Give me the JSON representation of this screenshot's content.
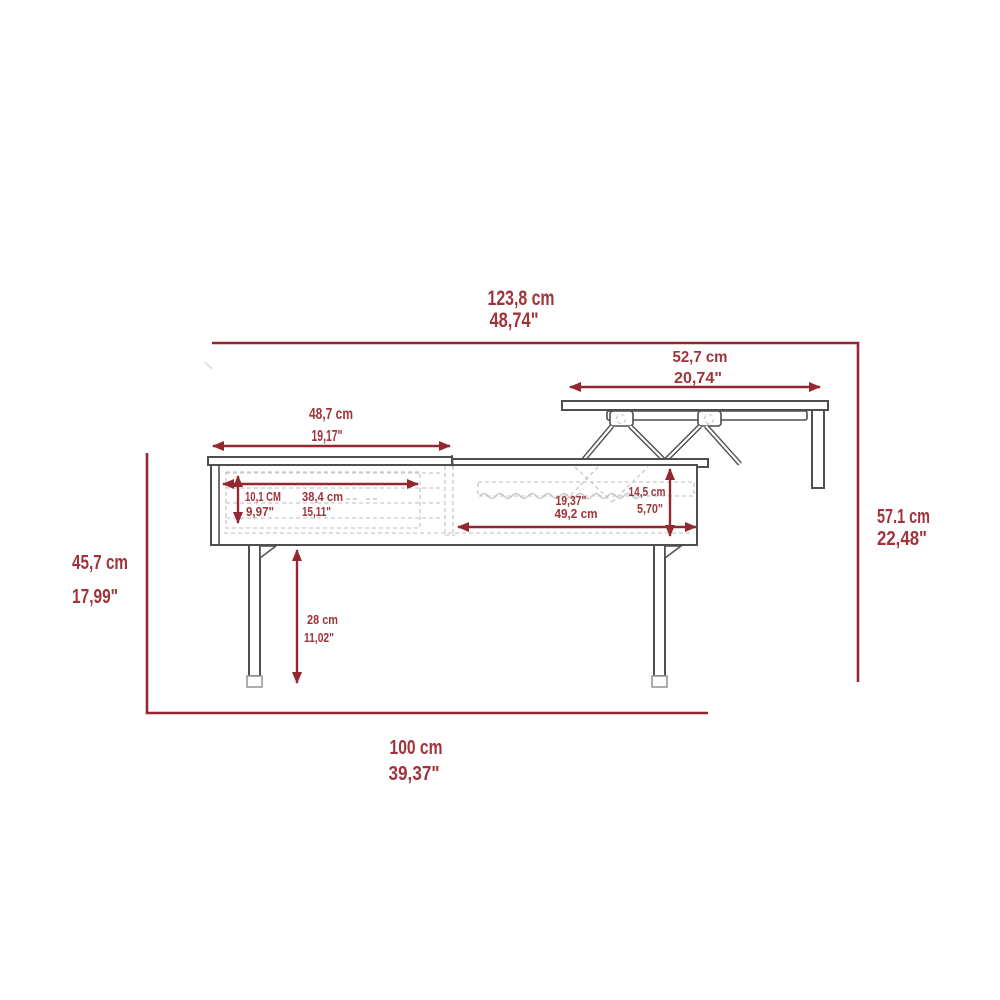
{
  "diagram_type": "furniture-dimension-diagram",
  "subject": "lift-top coffee table side elevation with dimensions",
  "colors": {
    "dimension_red": "#9f343b",
    "dimension_line_red": "#942831",
    "furniture_outline": "#4f4f4f",
    "furniture_dashed": "#c9c9c9",
    "background": "#ffffff"
  },
  "dims": {
    "overall_width": {
      "cm": "123,8 cm",
      "in": "48,74\""
    },
    "lift_top_width": {
      "cm": "52,7 cm",
      "in": "20,74\""
    },
    "left_top_width": {
      "cm": "48,7 cm",
      "in": "19,17\""
    },
    "open_height": {
      "cm": "57.1 cm",
      "in": "22,48\""
    },
    "table_height": {
      "cm": "45,7 cm",
      "in": "17,99\""
    },
    "base_width": {
      "cm": "100 cm",
      "in": "39,37\""
    },
    "drawer_height": {
      "cm": "10,1 CM",
      "in": "9,97\""
    },
    "drawer_width": {
      "cm": "38,4 cm",
      "in": "15,11\""
    },
    "compartment_width": {
      "in": "19,37\"",
      "cm": "49,2 cm"
    },
    "compartment_height": {
      "cm": "14,5 cm",
      "in": "5,70\""
    },
    "leg_height": {
      "cm": "28 cm",
      "in": "11,02\""
    }
  }
}
